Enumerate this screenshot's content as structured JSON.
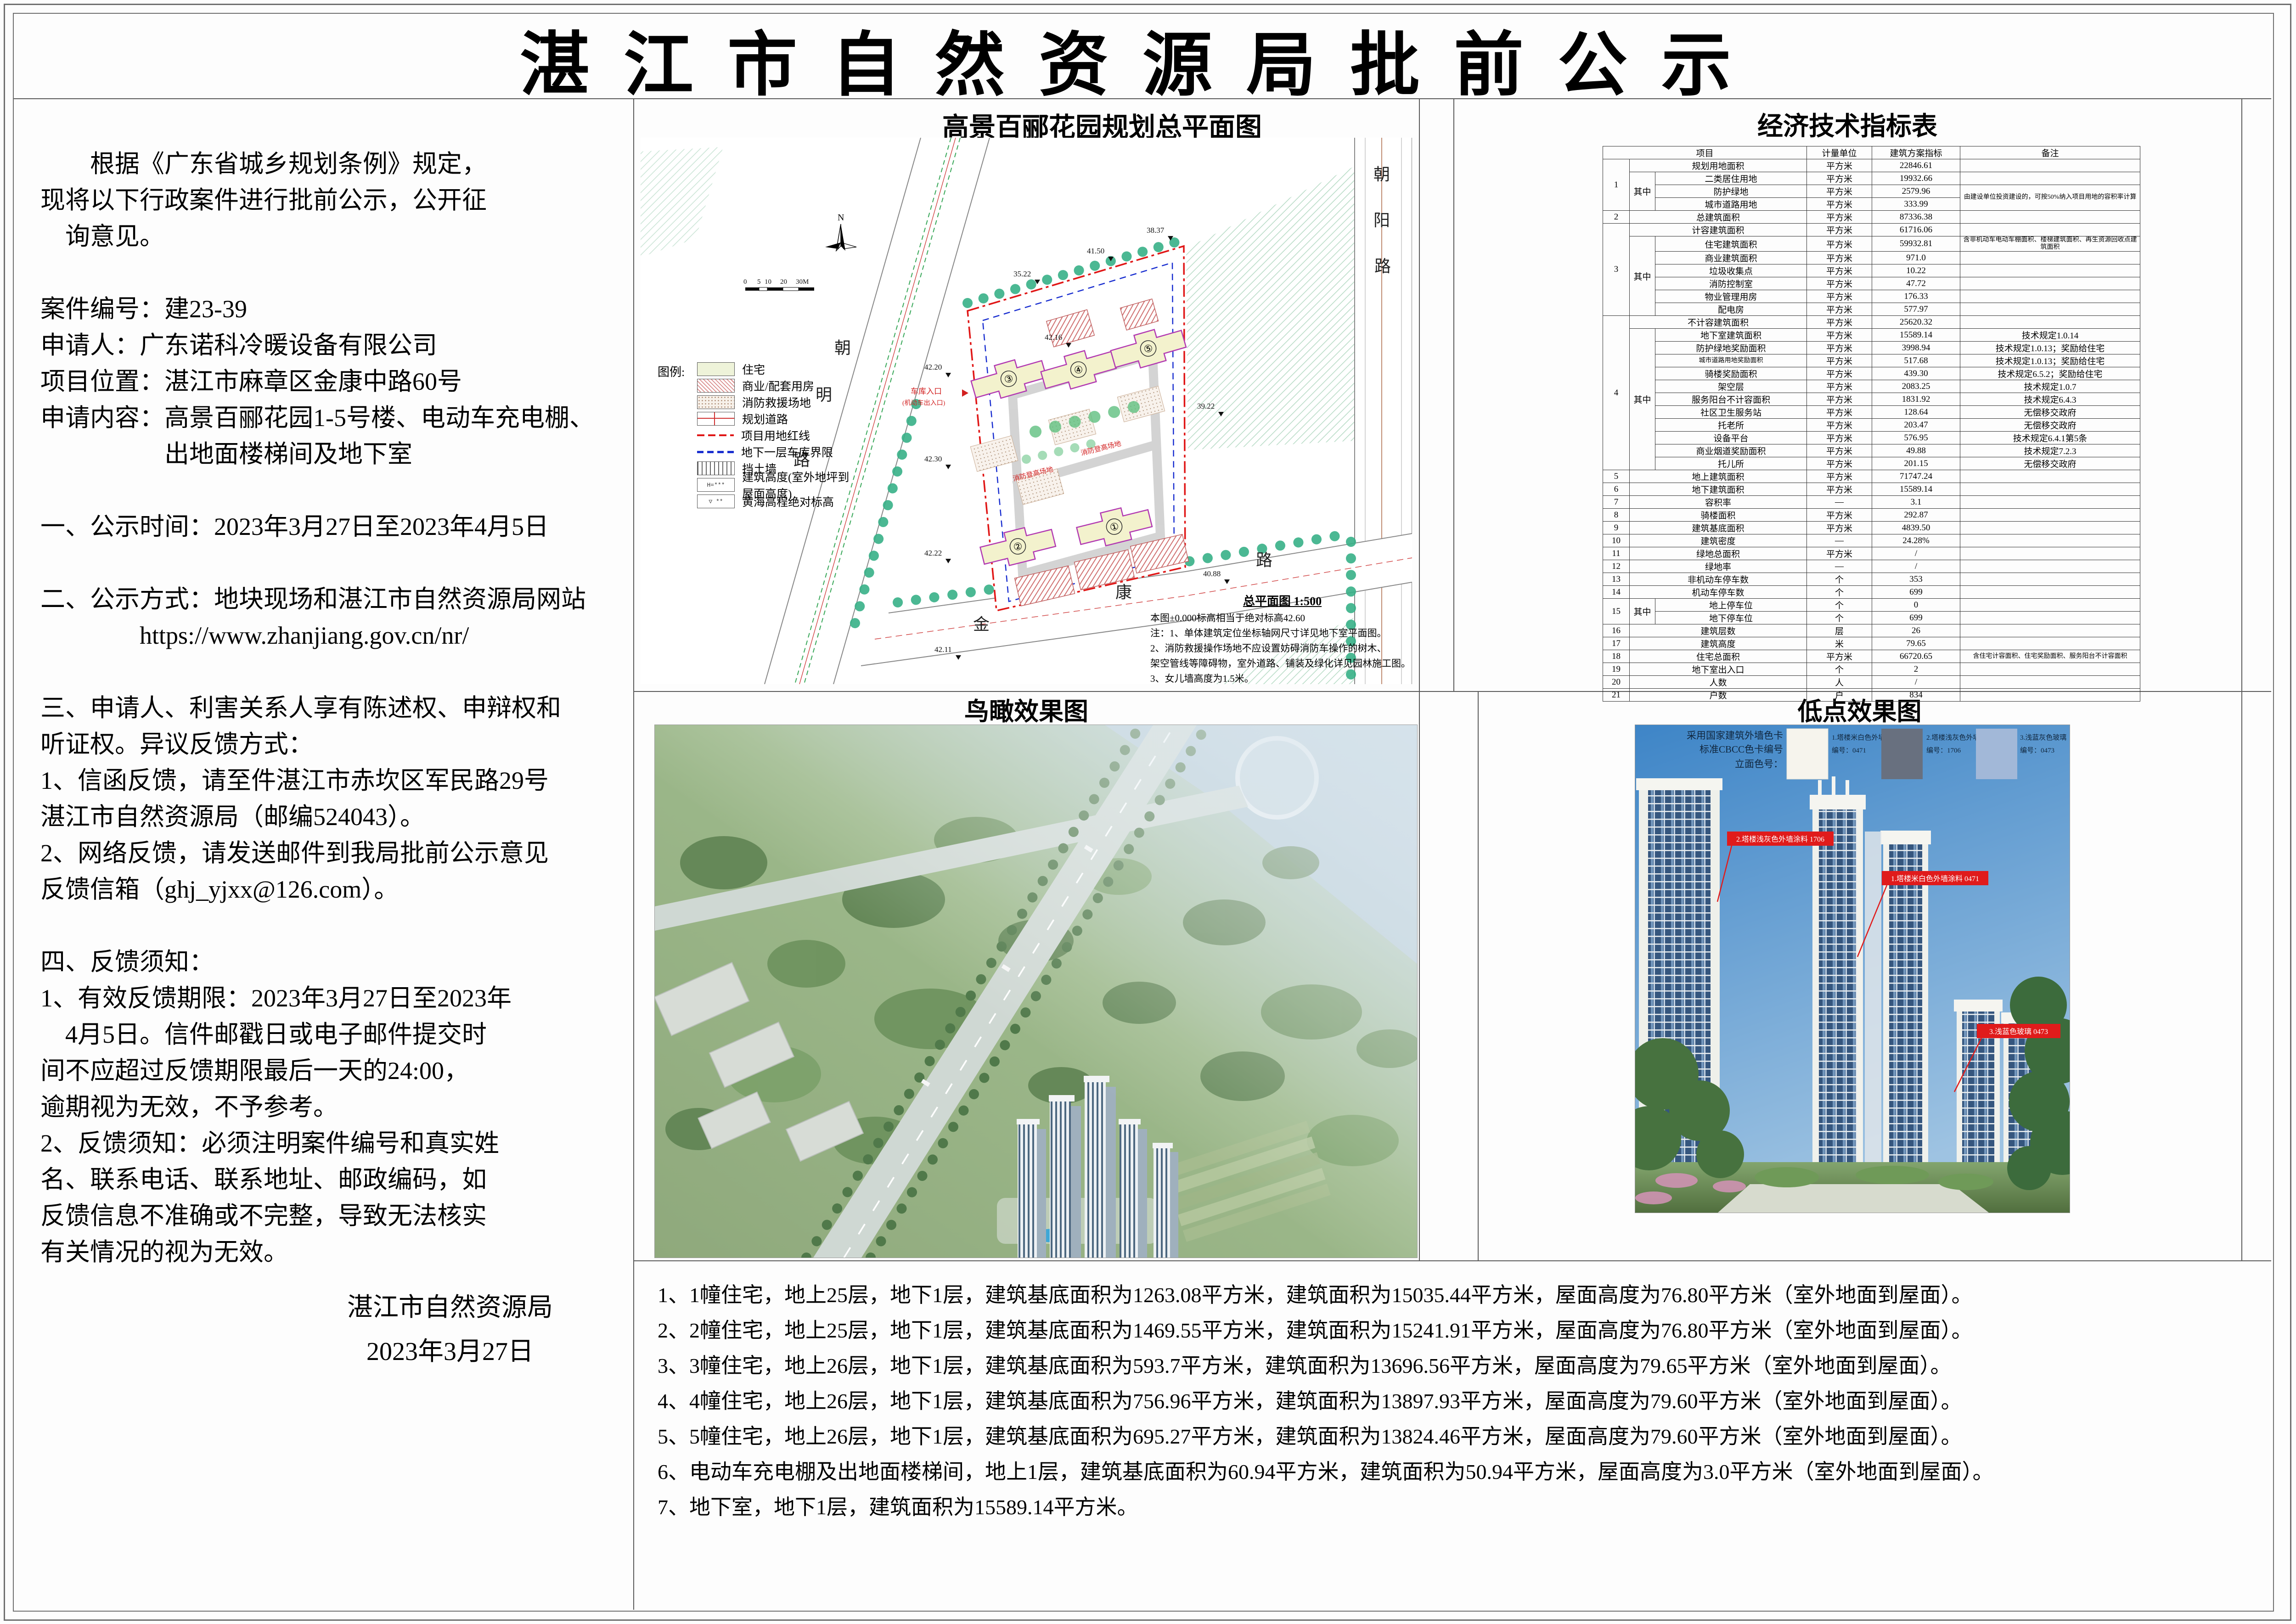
{
  "page": {
    "title": "湛 江 市 自 然 资 源 局 批 前 公 示"
  },
  "notice": {
    "lines": [
      "　　根据《广东省城乡规划条例》规定，",
      "现将以下行政案件进行批前公示，公开征",
      "　询意见。",
      "",
      "案件编号：建23-39",
      "申请人：广东诺科冷暖设备有限公司",
      "项目位置：湛江市麻章区金康中路60号",
      "申请内容：高景百郦花园1-5号楼、电动车充电棚、",
      "　　　　　出地面楼梯间及地下室",
      "",
      "一、公示时间：2023年3月27日至2023年4月5日",
      "",
      "二、公示方式：地块现场和湛江市自然资源局网站",
      "　　　　https://www.zhanjiang.gov.cn/nr/",
      "",
      "三、申请人、利害关系人享有陈述权、申辩权和",
      "听证权。异议反馈方式：",
      "1、信函反馈，请至件湛江市赤坎区军民路29号",
      "湛江市自然资源局（邮编524043）。",
      "2、网络反馈，请发送邮件到我局批前公示意见",
      "反馈信箱（ghj_yjxx@126.com）。",
      "",
      "四、反馈须知：",
      "1、有效反馈期限：2023年3月27日至2023年",
      "　4月5日。信件邮戳日或电子邮件提交时",
      "间不应超过反馈期限最后一天的24:00，",
      "逾期视为无效，不予参考。",
      "2、反馈须知：必须注明案件编号和真实姓",
      "名、联系电话、联系地址、邮政编码，如",
      "反馈信息不准确或不完整，导致无法核实",
      "有关情况的视为无效。"
    ],
    "signature": [
      "湛江市自然资源局",
      "2023年3月27日"
    ]
  },
  "site_plan": {
    "title": "高景百郦花园规划总平面图",
    "drawing_title": "总平面图 1:500",
    "datum_note": "本图±0.000标高相当于绝对标高42.60",
    "notes": [
      "注：1、单体建筑定位坐标轴网尺寸详见地下室平面图。",
      "2、消防救援操作场地不应设置妨碍消防车操作的树木、",
      "架空管线等障碍物，室外道路、铺装及绿化详见园林施工图。",
      "3、女儿墙高度为1.5米。"
    ],
    "legend_title": "图例:",
    "legend": [
      {
        "label": "住宅",
        "swatch": "residential-fill"
      },
      {
        "label": "商业/配套用房",
        "swatch": "commercial-hatch"
      },
      {
        "label": "消防救援场地",
        "swatch": "fire-rescue-dots"
      },
      {
        "label": "规划道路",
        "swatch": "planned-road"
      },
      {
        "label": "项目用地红线",
        "swatch": "red-boundary-line"
      },
      {
        "label": "地下一层车库界限",
        "swatch": "garage-blue-dash"
      },
      {
        "label": "挡土墙",
        "swatch": "retaining-wall"
      },
      {
        "label": "建筑高度(室外地坪到屋面高度)",
        "swatch": "building-height-box"
      },
      {
        "label": "黄海高程绝对标高",
        "swatch": "elevation-mark"
      }
    ],
    "legend_glyphs": {
      "building_height": "H=***",
      "elevation": "▽ **"
    },
    "roads": {
      "chaoming": [
        "朝",
        "明",
        "路"
      ],
      "chaoyang": [
        "朝",
        "阳",
        "路"
      ],
      "jinkang": [
        "金",
        "康",
        "路"
      ]
    },
    "buildings": [
      "①",
      "②",
      "③",
      "④",
      "⑤"
    ],
    "spot_elevations": [
      "42.20",
      "42.30",
      "42.22",
      "42.11",
      "35.22",
      "41.50",
      "38.37",
      "39.22",
      "40.88",
      "42.16"
    ],
    "red_labels": {
      "garage_entry": "车库入口",
      "garage_entry_sub": "(机动车出入口)",
      "fire_ground_1": "消防登高场地",
      "fire_ground_2": "消防登高场地"
    },
    "scale_bar": [
      "0",
      "5",
      "10",
      "20",
      "30M"
    ],
    "north": "N"
  },
  "indicators": {
    "title": "经济技术指标表",
    "header": {
      "item": "项目",
      "unit": "计量单位",
      "value": "建筑方案指标",
      "note": "备注"
    },
    "rows": [
      [
        {
          "t": "1",
          "rs": 4
        },
        {
          "t": "规划用地面积",
          "cs": 2
        },
        {
          "t": "平方米"
        },
        {
          "t": "22846.61"
        },
        {
          "t": ""
        }
      ],
      [
        {
          "t": "其中",
          "rs": 3
        },
        {
          "t": "二类居住用地"
        },
        {
          "t": "平方米"
        },
        {
          "t": "19932.66"
        },
        {
          "t": ""
        }
      ],
      [
        {
          "t": "防护绿地"
        },
        {
          "t": "平方米"
        },
        {
          "t": "2579.96"
        },
        {
          "t": "由建设单位投资建设的，可按50%纳入项目用地的容积率计算",
          "rs": 2,
          "cls": "small"
        }
      ],
      [
        {
          "t": "城市道路用地"
        },
        {
          "t": "平方米"
        },
        {
          "t": "333.99"
        }
      ],
      [
        {
          "t": "2"
        },
        {
          "t": "总建筑面积",
          "cs": 2
        },
        {
          "t": "平方米"
        },
        {
          "t": "87336.38"
        },
        {
          "t": ""
        }
      ],
      [
        {
          "t": "3",
          "rs": 7
        },
        {
          "t": "计容建筑面积",
          "cs": 2
        },
        {
          "t": "平方米"
        },
        {
          "t": "61716.06"
        },
        {
          "t": ""
        }
      ],
      [
        {
          "t": "其中",
          "rs": 6
        },
        {
          "t": "住宅建筑面积"
        },
        {
          "t": "平方米"
        },
        {
          "t": "59932.81"
        },
        {
          "t": "含非机动车电动车棚面积、楼梯建筑面积、再生资源回收点建筑面积",
          "cls": "small"
        }
      ],
      [
        {
          "t": "商业建筑面积"
        },
        {
          "t": "平方米"
        },
        {
          "t": "971.0"
        },
        {
          "t": ""
        }
      ],
      [
        {
          "t": "垃圾收集点"
        },
        {
          "t": "平方米"
        },
        {
          "t": "10.22"
        },
        {
          "t": ""
        }
      ],
      [
        {
          "t": "消防控制室"
        },
        {
          "t": "平方米"
        },
        {
          "t": "47.72"
        },
        {
          "t": ""
        }
      ],
      [
        {
          "t": "物业管理用房"
        },
        {
          "t": "平方米"
        },
        {
          "t": "176.33"
        },
        {
          "t": ""
        }
      ],
      [
        {
          "t": "配电房"
        },
        {
          "t": "平方米"
        },
        {
          "t": "577.97"
        },
        {
          "t": ""
        }
      ],
      [
        {
          "t": "4",
          "rs": 12
        },
        {
          "t": "不计容建筑面积",
          "cs": 2
        },
        {
          "t": "平方米"
        },
        {
          "t": "25620.32"
        },
        {
          "t": ""
        }
      ],
      [
        {
          "t": "其中",
          "rs": 11
        },
        {
          "t": "地下室建筑面积"
        },
        {
          "t": "平方米"
        },
        {
          "t": "15589.14"
        },
        {
          "t": "技术规定1.0.14"
        }
      ],
      [
        {
          "t": "防护绿地奖励面积"
        },
        {
          "t": "平方米"
        },
        {
          "t": "3998.94"
        },
        {
          "t": "技术规定1.0.13；奖励给住宅"
        }
      ],
      [
        {
          "t": "城市道路用地奖励面积",
          "cls": "small"
        },
        {
          "t": "平方米"
        },
        {
          "t": "517.68"
        },
        {
          "t": "技术规定1.0.13；奖励给住宅"
        }
      ],
      [
        {
          "t": "骑楼奖励面积"
        },
        {
          "t": "平方米"
        },
        {
          "t": "439.30"
        },
        {
          "t": "技术规定6.5.2；奖励给住宅"
        }
      ],
      [
        {
          "t": "架空层"
        },
        {
          "t": "平方米"
        },
        {
          "t": "2083.25"
        },
        {
          "t": "技术规定1.0.7"
        }
      ],
      [
        {
          "t": "服务阳台不计容面积"
        },
        {
          "t": "平方米"
        },
        {
          "t": "1831.92"
        },
        {
          "t": "技术规定6.4.3"
        }
      ],
      [
        {
          "t": "社区卫生服务站"
        },
        {
          "t": "平方米"
        },
        {
          "t": "128.64"
        },
        {
          "t": "无偿移交政府"
        }
      ],
      [
        {
          "t": "托老所"
        },
        {
          "t": "平方米"
        },
        {
          "t": "203.47"
        },
        {
          "t": "无偿移交政府"
        }
      ],
      [
        {
          "t": "设备平台"
        },
        {
          "t": "平方米"
        },
        {
          "t": "576.95"
        },
        {
          "t": "技术规定6.4.1第5条"
        }
      ],
      [
        {
          "t": "商业烟道奖励面积"
        },
        {
          "t": "平方米"
        },
        {
          "t": "49.88"
        },
        {
          "t": "技术规定7.2.3"
        }
      ],
      [
        {
          "t": "托儿所"
        },
        {
          "t": "平方米"
        },
        {
          "t": "201.15"
        },
        {
          "t": "无偿移交政府"
        }
      ],
      [
        {
          "t": "5"
        },
        {
          "t": "地上建筑面积",
          "cs": 2
        },
        {
          "t": "平方米"
        },
        {
          "t": "71747.24"
        },
        {
          "t": ""
        }
      ],
      [
        {
          "t": "6"
        },
        {
          "t": "地下建筑面积",
          "cs": 2
        },
        {
          "t": "平方米"
        },
        {
          "t": "15589.14"
        },
        {
          "t": ""
        }
      ],
      [
        {
          "t": "7"
        },
        {
          "t": "容积率",
          "cs": 2
        },
        {
          "t": "—"
        },
        {
          "t": "3.1"
        },
        {
          "t": ""
        }
      ],
      [
        {
          "t": "8"
        },
        {
          "t": "骑楼面积",
          "cs": 2
        },
        {
          "t": "平方米"
        },
        {
          "t": "292.87"
        },
        {
          "t": ""
        }
      ],
      [
        {
          "t": "9"
        },
        {
          "t": "建筑基底面积",
          "cs": 2
        },
        {
          "t": "平方米"
        },
        {
          "t": "4839.50"
        },
        {
          "t": ""
        }
      ],
      [
        {
          "t": "10"
        },
        {
          "t": "建筑密度",
          "cs": 2
        },
        {
          "t": "—"
        },
        {
          "t": "24.28%"
        },
        {
          "t": ""
        }
      ],
      [
        {
          "t": "11"
        },
        {
          "t": "绿地总面积",
          "cs": 2
        },
        {
          "t": "平方米"
        },
        {
          "t": "/"
        },
        {
          "t": ""
        }
      ],
      [
        {
          "t": "12"
        },
        {
          "t": "绿地率",
          "cs": 2
        },
        {
          "t": "—"
        },
        {
          "t": "/"
        },
        {
          "t": ""
        }
      ],
      [
        {
          "t": "13"
        },
        {
          "t": "非机动车停车数",
          "cs": 2
        },
        {
          "t": "个"
        },
        {
          "t": "353"
        },
        {
          "t": ""
        }
      ],
      [
        {
          "t": "14"
        },
        {
          "t": "机动车停车数",
          "cs": 2
        },
        {
          "t": "个"
        },
        {
          "t": "699"
        },
        {
          "t": ""
        }
      ],
      [
        {
          "t": "15",
          "rs": 2
        },
        {
          "t": "其中",
          "rs": 2
        },
        {
          "t": "地上停车位"
        },
        {
          "t": "个"
        },
        {
          "t": "0"
        },
        {
          "t": ""
        }
      ],
      [
        {
          "t": "地下停车位"
        },
        {
          "t": "个"
        },
        {
          "t": "699"
        },
        {
          "t": ""
        }
      ],
      [
        {
          "t": "16"
        },
        {
          "t": "建筑层数",
          "cs": 2
        },
        {
          "t": "层"
        },
        {
          "t": "26"
        },
        {
          "t": ""
        }
      ],
      [
        {
          "t": "17"
        },
        {
          "t": "建筑高度",
          "cs": 2
        },
        {
          "t": "米"
        },
        {
          "t": "79.65"
        },
        {
          "t": ""
        }
      ],
      [
        {
          "t": "18"
        },
        {
          "t": "住宅总面积",
          "cs": 2
        },
        {
          "t": "平方米"
        },
        {
          "t": "66720.65"
        },
        {
          "t": "含住宅计容面积、住宅奖励面积、服务阳台不计容面积",
          "cls": "small"
        }
      ],
      [
        {
          "t": "19"
        },
        {
          "t": "地下室出入口",
          "cs": 2
        },
        {
          "t": "个"
        },
        {
          "t": "2"
        },
        {
          "t": ""
        }
      ],
      [
        {
          "t": "20"
        },
        {
          "t": "人数",
          "cs": 2
        },
        {
          "t": "人"
        },
        {
          "t": "/"
        },
        {
          "t": ""
        }
      ],
      [
        {
          "t": "21"
        },
        {
          "t": "户数",
          "cs": 2
        },
        {
          "t": "户"
        },
        {
          "t": "834"
        },
        {
          "t": ""
        }
      ]
    ]
  },
  "aerial": {
    "title": "鸟瞰效果图"
  },
  "lowpoint": {
    "title": "低点效果图",
    "legend": {
      "intro": [
        "采用国家建筑外墙色卡",
        "标准CBCC色卡编号",
        "立面色号："
      ],
      "items": [
        {
          "label": "1.塔楼米白色外墙涂料",
          "code": "编号：0471",
          "color": "#f6f4ed"
        },
        {
          "label": "2.塔楼浅灰色外墙涂料",
          "code": "编号：1706",
          "color": "#68707f"
        },
        {
          "label": "3.浅蓝灰色玻璃",
          "code": "编号：0473",
          "color": "#a2b8d8"
        }
      ]
    },
    "callouts": [
      {
        "text": "2.塔楼浅灰色外墙涂料 1706"
      },
      {
        "text": "1.塔楼米白色外墙涂料 0471"
      },
      {
        "text": "3.浅蓝色玻璃 0473"
      }
    ],
    "colors": {
      "callout_red": "#e01b1b",
      "sky_top": "#3e85c7",
      "sky_bottom": "#9ec3e2"
    }
  },
  "notes": {
    "lines": [
      "1、1幢住宅，地上25层，地下1层，建筑基底面积为1263.08平方米，建筑面积为15035.44平方米，屋面高度为76.80平方米（室外地面到屋面）。",
      "2、2幢住宅，地上25层，地下1层，建筑基底面积为1469.55平方米，建筑面积为15241.91平方米，屋面高度为76.80平方米（室外地面到屋面）。",
      "3、3幢住宅，地上26层，地下1层，建筑基底面积为593.7平方米，建筑面积为13696.56平方米，屋面高度为79.65平方米（室外地面到屋面）。",
      "4、4幢住宅，地上26层，地下1层，建筑基底面积为756.96平方米，建筑面积为13897.93平方米，屋面高度为79.60平方米（室外地面到屋面）。",
      "5、5幢住宅，地上26层，地下1层，建筑基底面积为695.27平方米，建筑面积为13824.46平方米，屋面高度为79.60平方米（室外地面到屋面）。",
      "6、电动车充电棚及出地面楼梯间，地上1层，建筑基底面积为60.94平方米，建筑面积为50.94平方米，屋面高度为3.0平方米（室外地面到屋面）。",
      "7、地下室，地下1层，建筑面积为15589.14平方米。"
    ]
  }
}
